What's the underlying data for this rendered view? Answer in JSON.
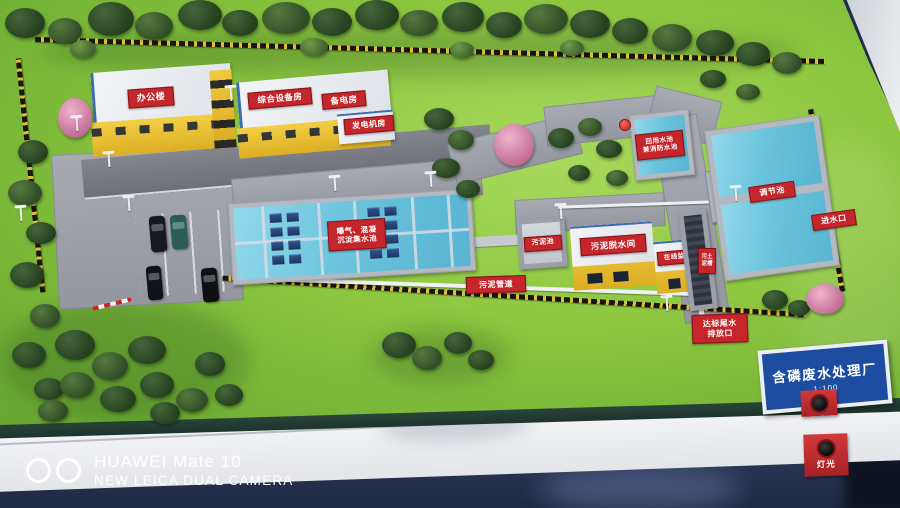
{
  "sign": {
    "title": "含磷废水处理厂",
    "scale": "1:100"
  },
  "buildings": {
    "office": "办公楼",
    "equipment_room": "综合设备房",
    "backup_power_room": "备电房",
    "generator_room": "发电机房",
    "sludge_dewatering_room": "污泥脱水间",
    "online_monitoring_room": "在线监测房"
  },
  "pools": {
    "aeration_sedimentation": {
      "line1": "曝气、混凝",
      "line2": "沉淀集水池"
    },
    "sludge_pool": "污泥池",
    "reuse_fire_pool": {
      "line1": "回用水池",
      "line2": "兼消防水池"
    },
    "regulating_pool": "调节池"
  },
  "labels": {
    "water_inlet": "进水口",
    "sludge_pipeline": "污泥管道",
    "outfall": {
      "line1": "达标尾水",
      "line2": "排放口"
    },
    "channel": {
      "line1": "污土",
      "line2": "泥槽"
    }
  },
  "panel": {
    "light_button": "灯光"
  },
  "watermark": {
    "line1": "HUAWEI Mate 10",
    "line2": "NEW LEICA DUAL CAMERA"
  },
  "colors": {
    "grass": "#8cc63f",
    "building_yellow": "#eec832",
    "label_red": "#c4262b",
    "water_blue": "#6cc4dd",
    "sign_blue": "#1c4da0",
    "floor_navy": "#222d49"
  }
}
